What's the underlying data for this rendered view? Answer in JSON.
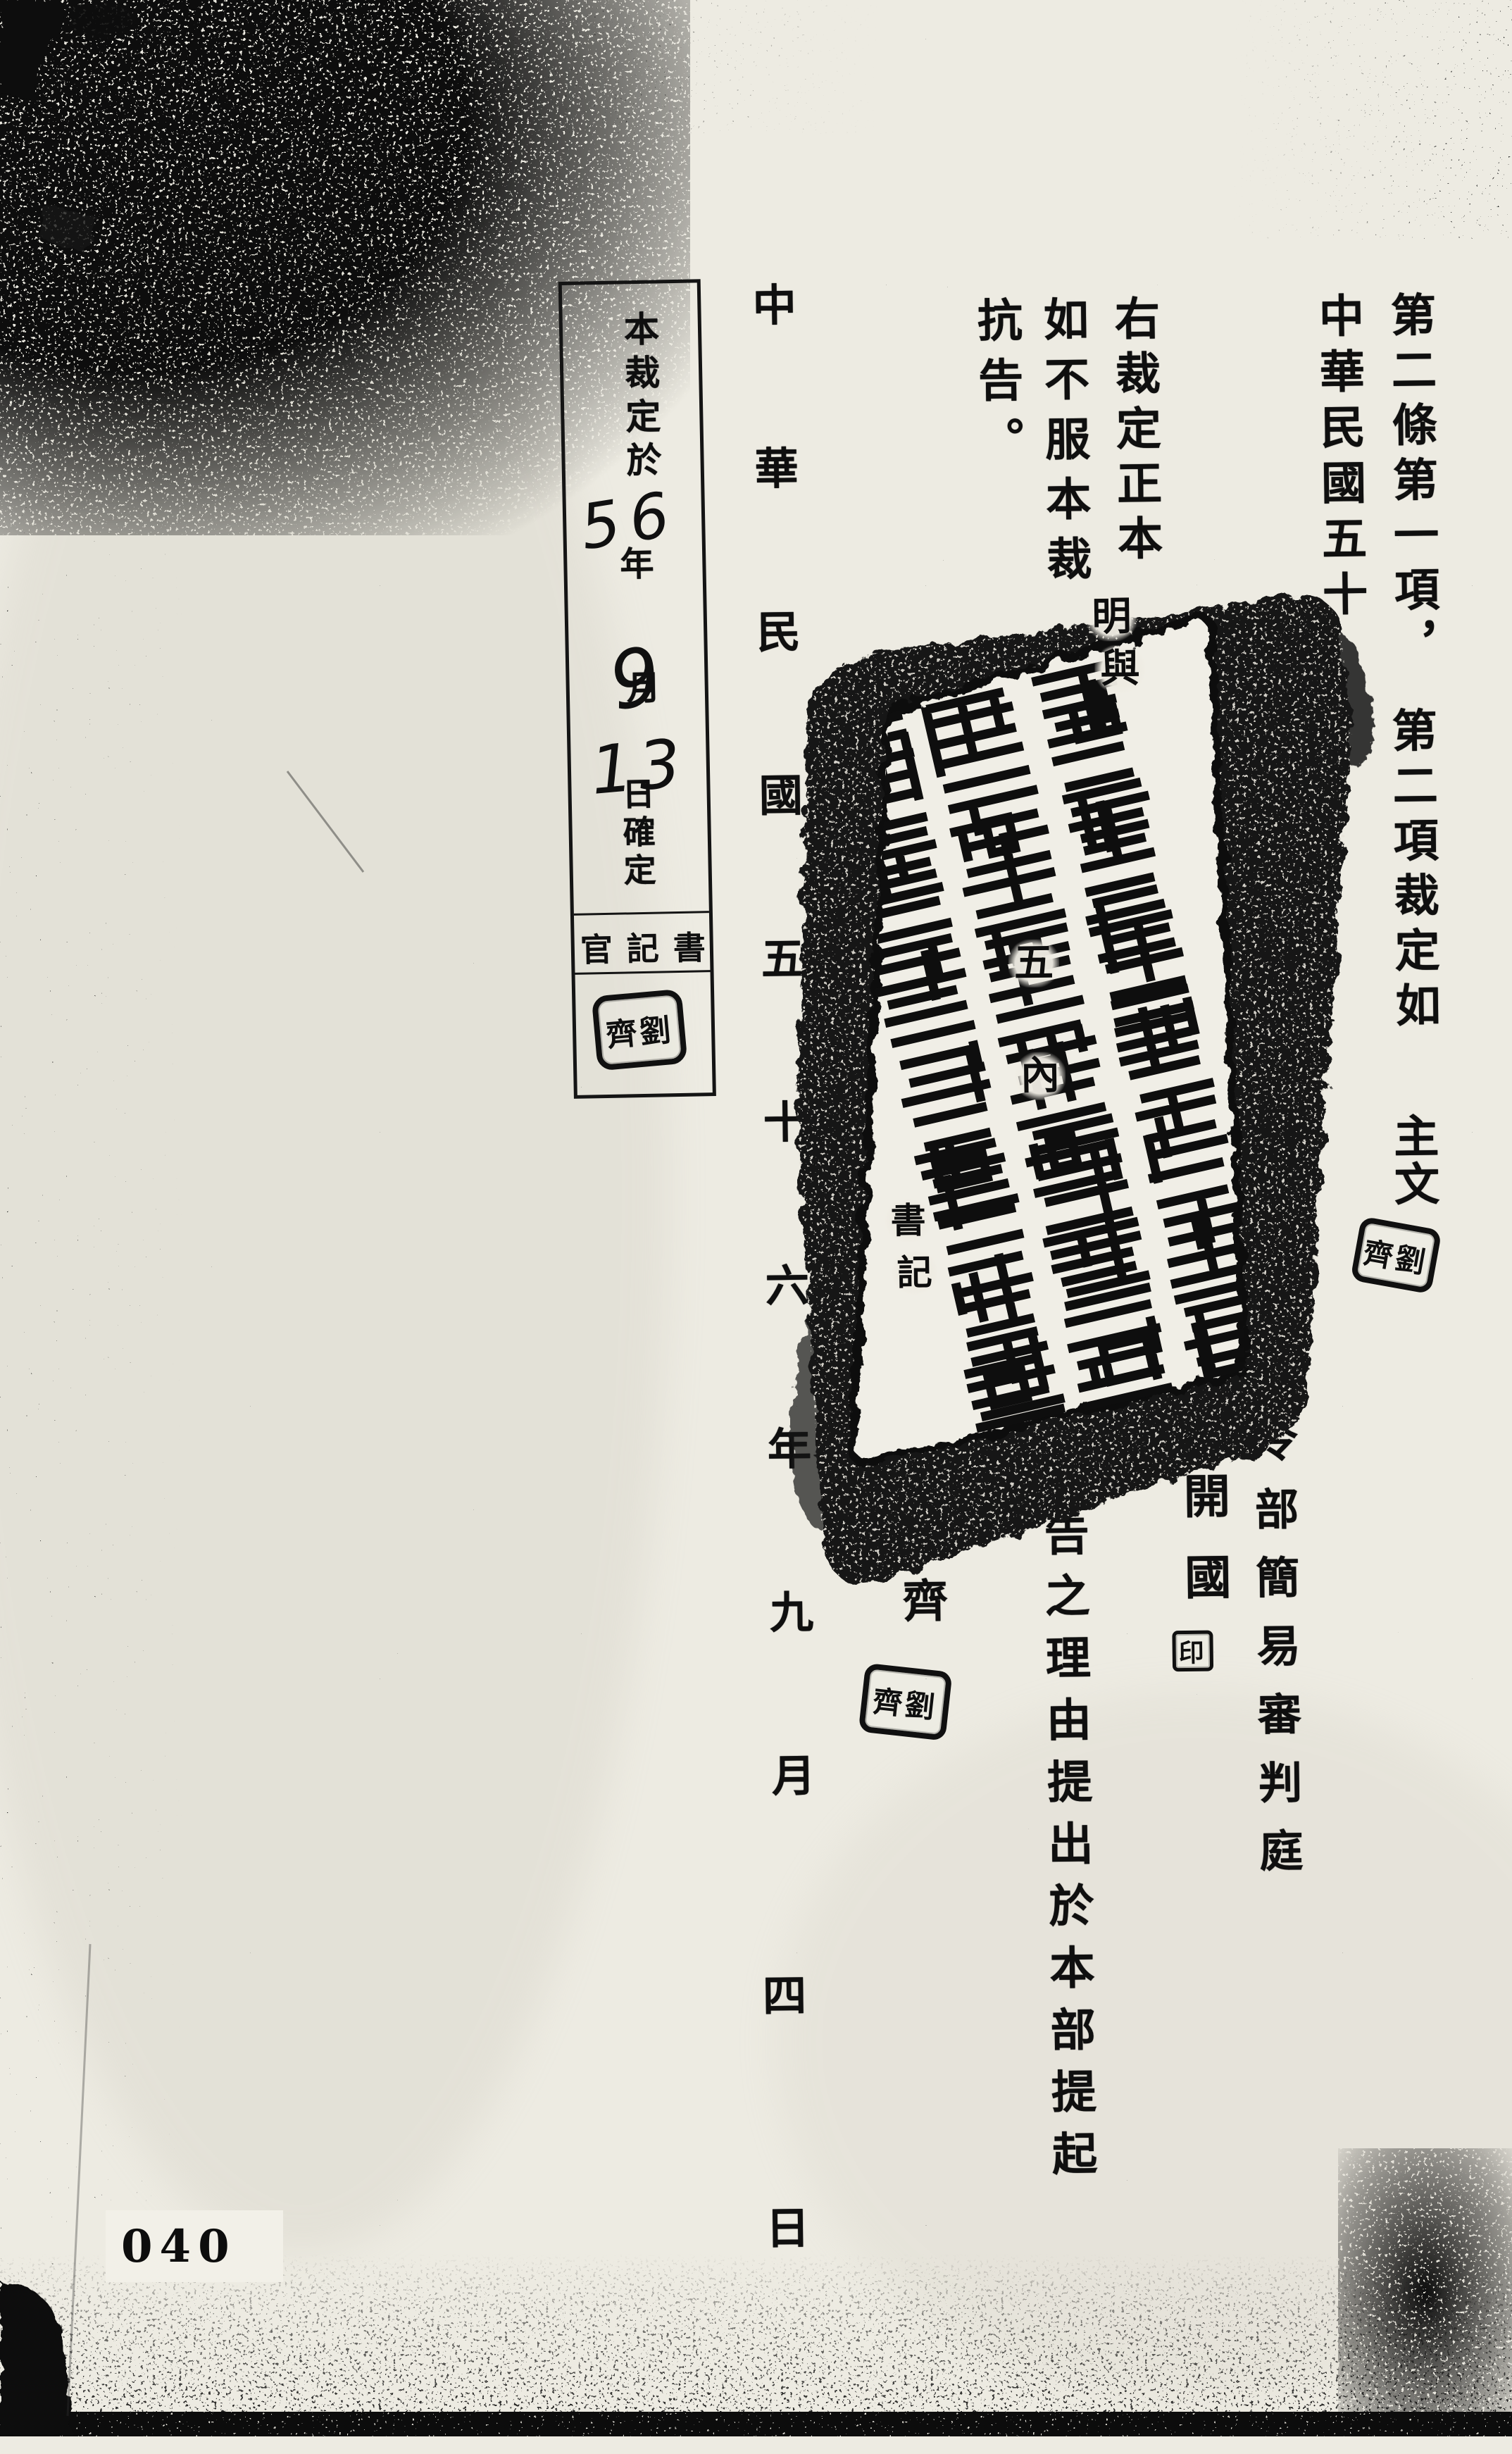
{
  "page": {
    "number": "040"
  },
  "ruling": {
    "line_end_1": "第二條第一項，",
    "line_end_2": "第二項裁定如",
    "line_end_3": "主文",
    "date_inline": "中華民國五十"
  },
  "certification": {
    "text": "右裁定正本"
  },
  "appeal": {
    "part_1": "如不服本裁",
    "part_2": "述抗告之理由提出於本部提起",
    "part_3": "抗告。"
  },
  "court": {
    "name_visible": "令部簡易審判庭",
    "judge_name": "蕭開國",
    "judge_seal": "印",
    "clerk_name": "劉齊"
  },
  "date_line": {
    "part_1": "中華民國五十六年九月",
    "part_2": "四日"
  },
  "fragments_over_stamp": {
    "cert_1": "明",
    "cert_2": "與",
    "appeal_1": "五",
    "appeal_2": "內",
    "clerk_title_1": "書",
    "clerk_title_2": "記"
  },
  "confirmation_box": {
    "heading": "本裁定於",
    "year_value": "56",
    "year_label": "年",
    "month_value": "9",
    "month_label": "月",
    "day_value": "13",
    "day_suffix": "日確定",
    "clerk_row": "官記書"
  },
  "seals": {
    "personal_seal_text": "齊劉"
  },
  "colors": {
    "ink": "#0f0f0f",
    "paper": "#edebe2",
    "stamp": "#121212"
  }
}
